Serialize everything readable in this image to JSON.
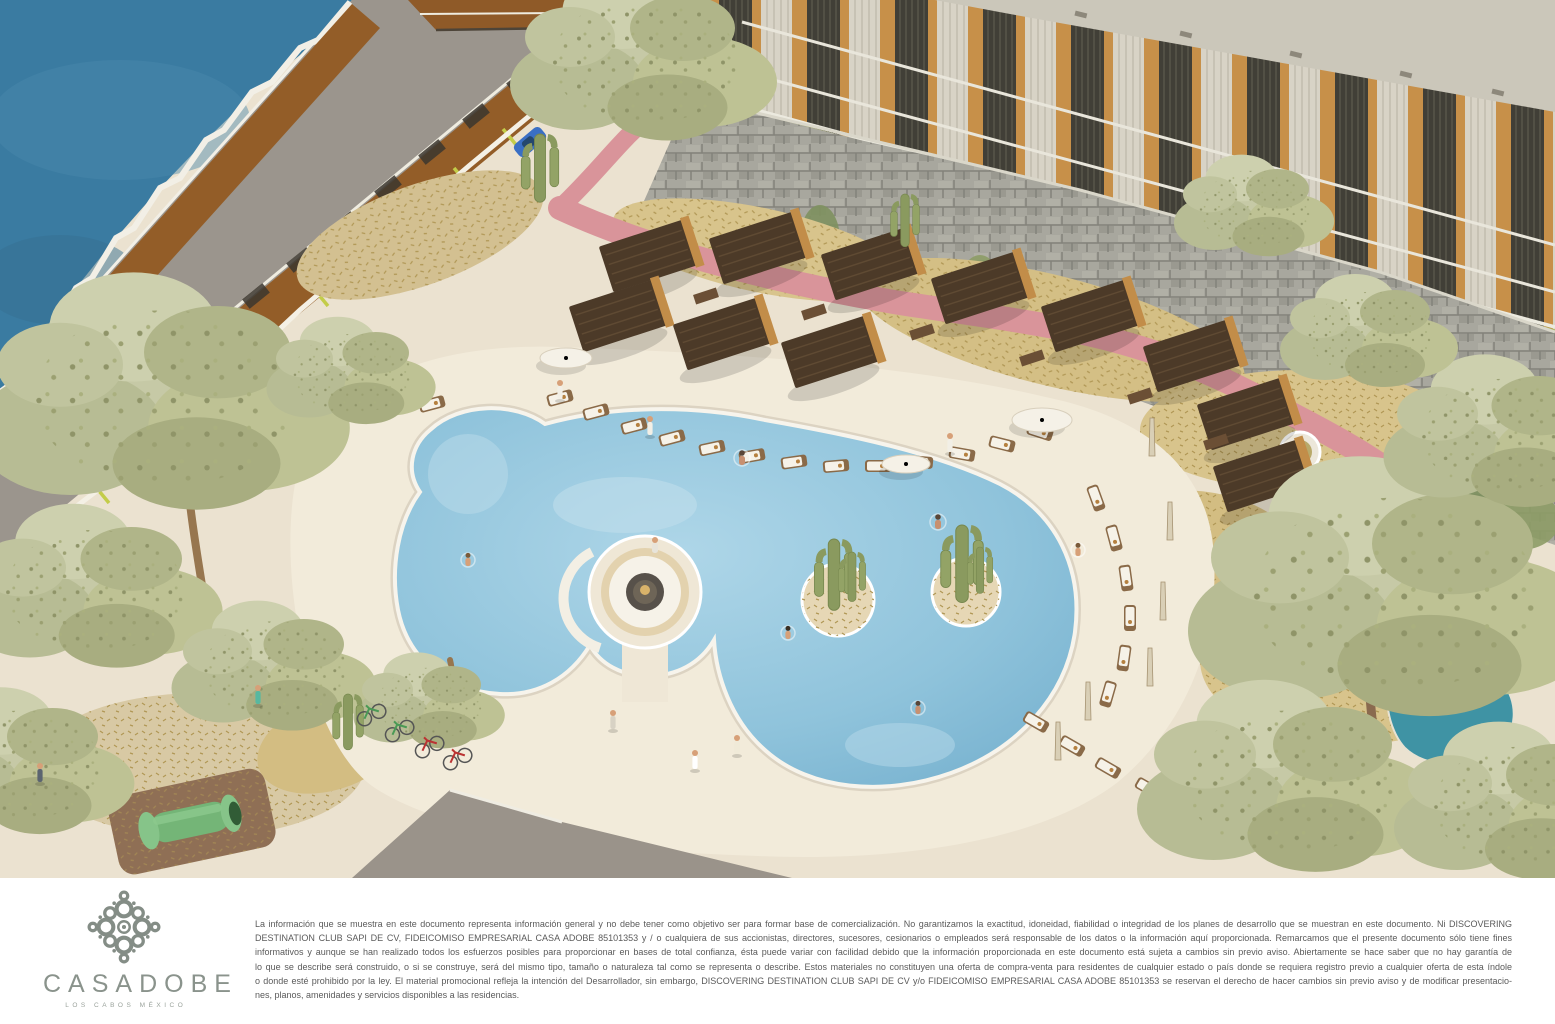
{
  "brand": {
    "wordmark": "CASADOBE",
    "tagline": "LOS CABOS MÉXICO"
  },
  "footer": {
    "disclaimer_lines": [
      "La información que se muestra en este documento representa información general y no debe tener como objetivo ser para formar base de comercialización. No garantizamos la exactitud, idoneidad, fiabilidad o integridad de los planes de desarrollo que se muestran en este documento.  Ni DISCOVERING",
      "DESTINATION CLUB SAPI DE CV, FIDEICOMISO EMPRESARIAL CASA ADOBE 85101353 y / o cualquiera de sus accionistas, directores, sucesores, cesionarios o empleados será responsable de los datos o la información aquí proporcionada. Remarcamos que el presente documento sólo tiene fines",
      "informativos y aunque se han realizado todos los esfuerzos posibles para proporcionar en bases de total confianza, ésta puede variar con facilidad debido que la información proporcionada en este documento está sujeta a cambios sin previo aviso. Abiertamente se hace saber que no hay garantía de",
      "lo que se describe será construido, o si se construye, será del mismo tipo, tamaño o naturaleza tal como se representa o describe.  Estos materiales no constituyen una oferta de compra-venta para residentes de cualquier estado o país donde se requiera registro previo a cualquier oferta de esta índole",
      "o donde esté prohibido por la ley. El material promocional refleja la intención del Desarrollador, sin embargo, DISCOVERING DESTINATION CLUB SAPI DE CV y/o FIDEICOMISO EMPRESARIAL CASA ADOBE 85101353 se reservan el derecho de hacer cambios sin previo aviso y de modificar presentacio-",
      "nes, planos, amenidades y servicios disponibles a las residencias."
    ]
  },
  "palette": {
    "ocean": "#3a7ba1",
    "sand": "#ebe2d0",
    "pool_deck": "#f2ebda",
    "pool_water": "#8fc3db",
    "scrub_gold": "#d8c48c",
    "tree_sage": "#c6c9a6",
    "cabana_roof": "#4c3a28",
    "wood_accent": "#c28d49",
    "stone_wall": "#a8a79e",
    "walkway_pink": "#d9949a",
    "road_gray": "#9b958d",
    "parking_stripe_lime": "#c3cc49",
    "logo_gray": "#868f88",
    "disclaimer_text": "#5a5a5a"
  },
  "scene": {
    "type": "aerial-resort-rendering",
    "landmarks": [
      "ocean",
      "terraced-parking",
      "condo-building",
      "stone-retaining-wall",
      "pink-walkway",
      "free-form-pool",
      "sunken-fire-pit-lounge",
      "cactus-islands",
      "cabanas",
      "sun-loungers",
      "desert-landscaping",
      "play-tunnel",
      "bicycles",
      "guests"
    ]
  }
}
